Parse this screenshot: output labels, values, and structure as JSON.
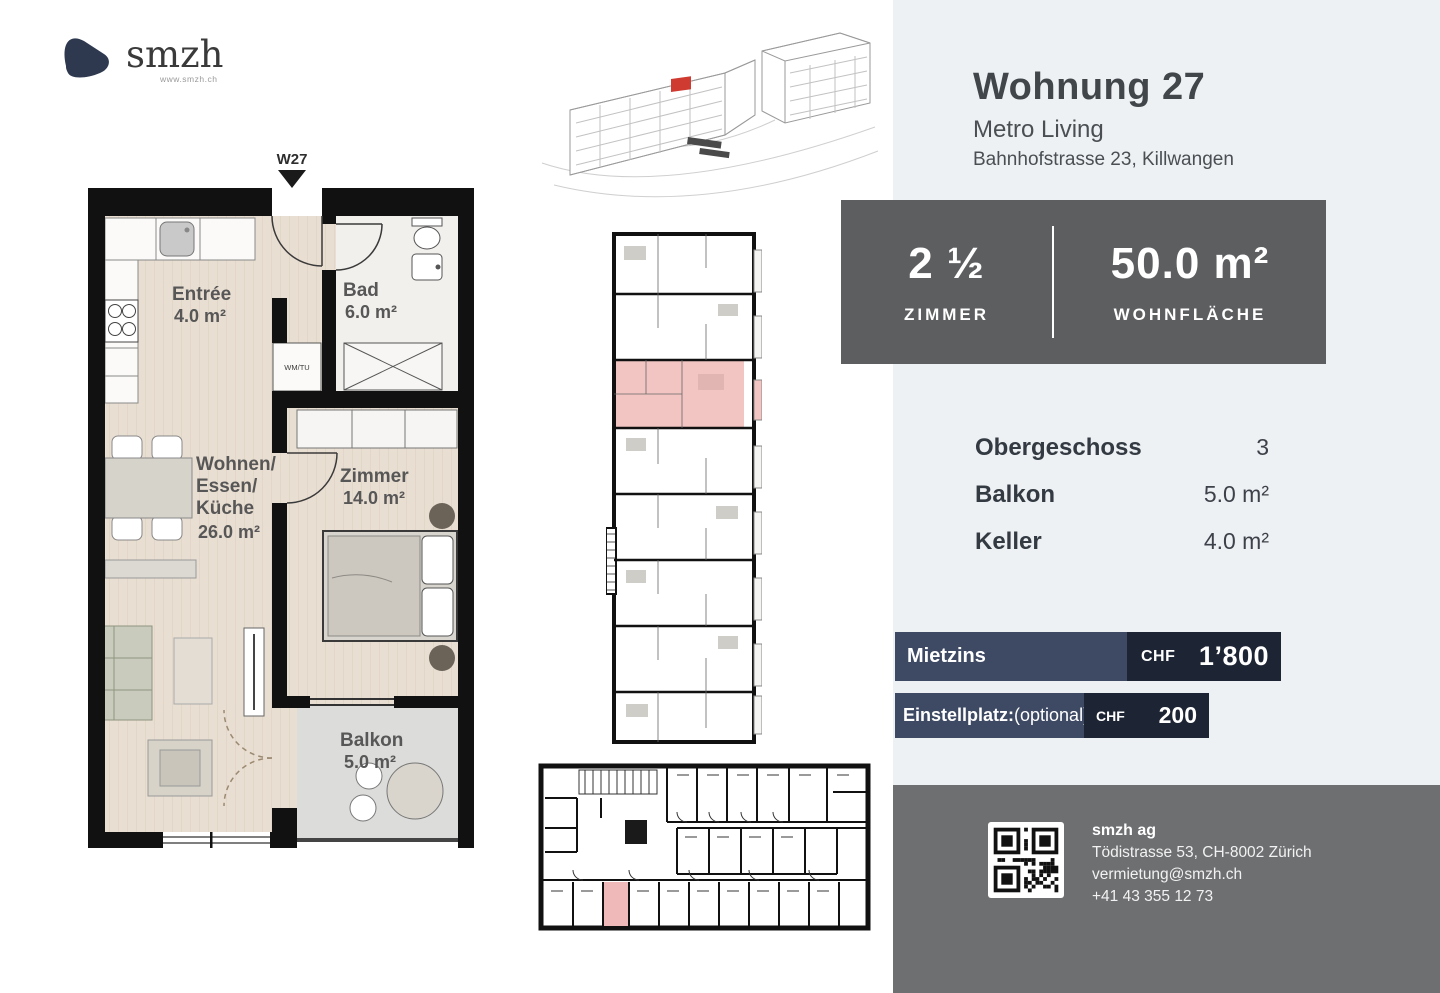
{
  "logo": {
    "brand": "smzh",
    "website": "www.smzh.ch"
  },
  "unit": {
    "marker": "W27",
    "title": "Wohnung 27",
    "project": "Metro Living",
    "address": "Bahnhofstrasse 23, Killwangen"
  },
  "floorplan": {
    "entree": {
      "name": "Entrée",
      "area": "4.0 m²"
    },
    "bad": {
      "name": "Bad",
      "area": "6.0 m²"
    },
    "wm_closet": "WM/TU",
    "wohnen": {
      "line1": "Wohnen/",
      "line2": "Essen/",
      "line3": "Küche",
      "area": "26.0 m²"
    },
    "zimmer": {
      "name": "Zimmer",
      "area": "14.0 m²"
    },
    "balkon": {
      "name": "Balkon",
      "area": "5.0 m²"
    }
  },
  "keyfacts": {
    "rooms_value": "2 ½",
    "rooms_label": "ZIMMER",
    "area_value": "50.0 m²",
    "area_label": "WOHNFLÄCHE"
  },
  "details": {
    "rows": [
      {
        "label": "Obergeschoss",
        "value": "3"
      },
      {
        "label": "Balkon",
        "value": "5.0 m²"
      },
      {
        "label": "Keller",
        "value": "4.0 m²"
      }
    ]
  },
  "pricing": {
    "rows": [
      {
        "label": "Mietzins",
        "suffix": "",
        "currency": "CHF",
        "amount": "1’800"
      },
      {
        "label": "Einstellplatz:",
        "suffix": "(optional)",
        "currency": "CHF",
        "amount": "200"
      }
    ]
  },
  "contact": {
    "company": "smzh ag",
    "address": "Tödistrasse 53, CH-8002 Zürich",
    "email": "vermietung@smzh.ch",
    "phone": "+41 43 355 12 73"
  },
  "colors": {
    "accent_dark_navy": "#1d2434",
    "accent_navy": "#3e4a64",
    "panel_bg": "#eef1f4",
    "box_gray": "#5d5e60",
    "footer_gray": "#6e6f71",
    "highlight_pink": "#f3c5c2",
    "marker_red": "#cf3b30"
  }
}
